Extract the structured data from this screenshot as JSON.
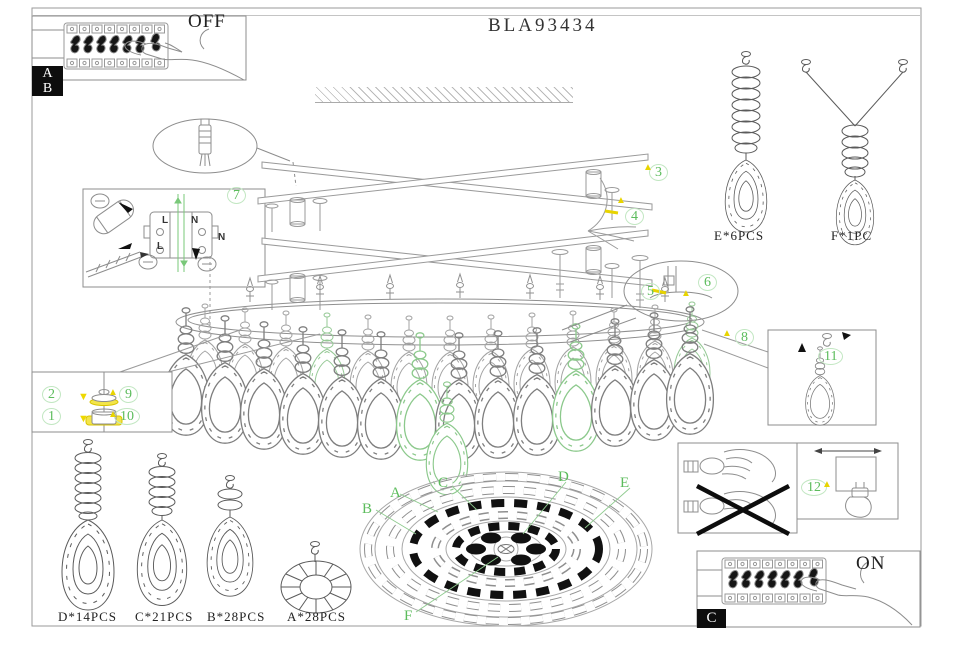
{
  "title": "BLA93434",
  "power": {
    "off": "OFF",
    "on": "ON"
  },
  "badges": {
    "ab_top": "A",
    "ab_bottom": "B",
    "c": "C"
  },
  "steps": {
    "1": "1",
    "2": "2",
    "3": "3",
    "4": "4",
    "5": "5",
    "6": "6",
    "7": "7",
    "8": "8",
    "9": "9",
    "10": "10",
    "11": "11",
    "12": "12"
  },
  "wiring": {
    "tl": "L",
    "tr": "N",
    "bl": "L",
    "r": "N"
  },
  "parts": {
    "d": "D*14PCS",
    "c": "C*21PCS",
    "b": "B*28PCS",
    "a": "A*28PCS",
    "e": "E*6PCS",
    "f": "F*1PC"
  },
  "plan": {
    "a": "A",
    "b": "B",
    "c": "C",
    "d": "D",
    "e": "E",
    "f": "F"
  },
  "icons": {
    "tri": "▲",
    "down": "▼"
  },
  "colors": {
    "green": "#5cbc5c",
    "yellow": "#e8d400",
    "line": "#9a9a9a",
    "black": "#111111"
  }
}
